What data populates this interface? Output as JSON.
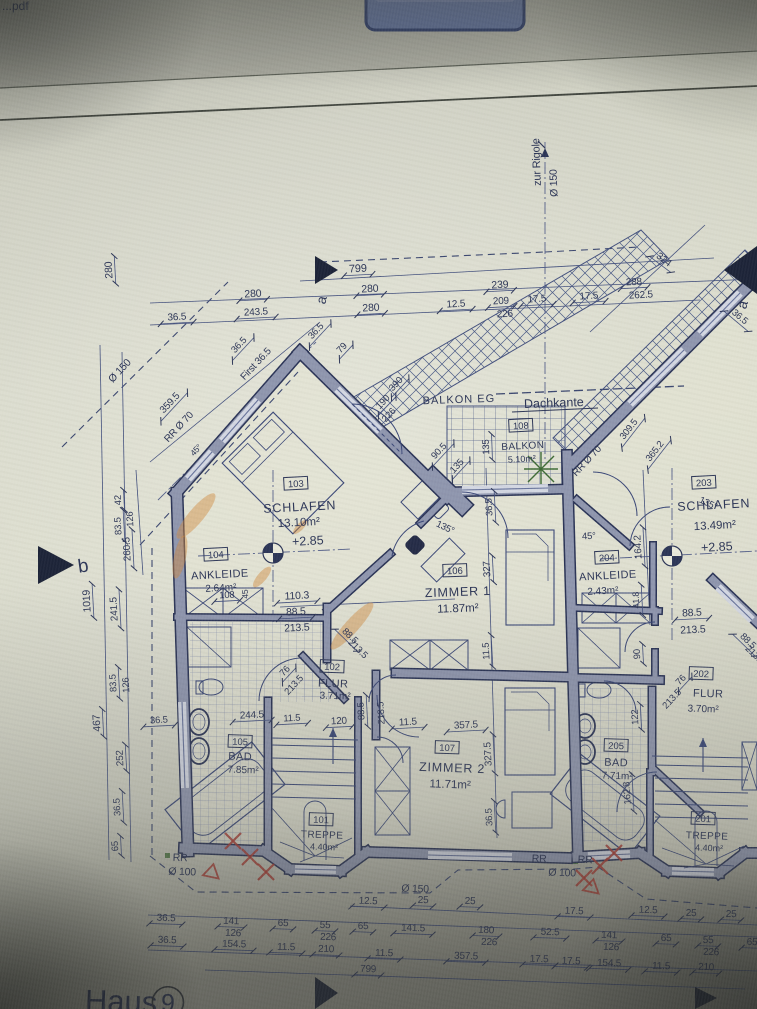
{
  "screen": {
    "filename_fragment": "...pdf"
  },
  "sheet": {
    "house_label": "Haus",
    "house_number": "9",
    "section_marker_a": "a",
    "section_marker_b": "b"
  },
  "plan_labels": {
    "balkon_eg": "BALKON EG",
    "dachkante": "Dachkante"
  },
  "rooms": [
    {
      "number": "103",
      "name": "SCHLAFEN",
      "area": "13.10m²",
      "level": "+2.85"
    },
    {
      "number": "104",
      "name": "ANKLEIDE",
      "area": "2.64m²"
    },
    {
      "number": "105",
      "name": "BAD",
      "area": "7.85m²"
    },
    {
      "number": "102",
      "name": "FLUR",
      "area": "3.71m²"
    },
    {
      "number": "101",
      "name": "TREPPE",
      "area": "4.40m²"
    },
    {
      "number": "106",
      "name": "ZIMMER 1",
      "area": "11.87m²"
    },
    {
      "number": "107",
      "name": "ZIMMER 2",
      "area": "11.71m²"
    },
    {
      "number": "108",
      "name": "BALKON",
      "area": "5.10m²"
    },
    {
      "number": "203",
      "name": "SCHLAFEN",
      "area": "13.49m²",
      "level": "+2.85"
    },
    {
      "number": "204",
      "name": "ANKLEIDE",
      "area": "2.43m²"
    },
    {
      "number": "205",
      "name": "BAD",
      "area": "7.71m²"
    },
    {
      "number": "202",
      "name": "FLUR",
      "area": "3.70m²"
    },
    {
      "number": "201",
      "name": "TREPPE",
      "area": "4.40m²"
    }
  ],
  "dim_texts": [
    "799",
    "280",
    "280",
    "239",
    "36.5",
    "243.5",
    "280",
    "12.5",
    "209",
    "226",
    "17.5",
    "17.5",
    "288",
    "262.5",
    "324",
    "36.5",
    "280",
    "42",
    "83.5",
    "126",
    "260.5",
    "1019",
    "241.5",
    "83.5",
    "126",
    "467",
    "252",
    "36.5",
    "65",
    "Ø 150",
    "359.5",
    "First 36.5",
    "RR Ø 70",
    "45°",
    "36.5",
    "36.5",
    "79",
    "zur Rigole",
    "Ø 150",
    "390",
    "190",
    "226",
    "90.5",
    "135",
    "135",
    "RR Ø 70",
    "309.5",
    "365.2",
    "135°",
    "135°",
    "45°",
    "45",
    "110.3",
    "88.5",
    "213.5",
    "108",
    "88.5",
    "213.5",
    "76",
    "213.5",
    "36.5",
    "327",
    "11.5",
    "88.5",
    "213.5",
    "120",
    "11.5",
    "357.5",
    "327.5",
    "36.5",
    "36.5",
    "244.5",
    "11.5",
    "164.2",
    "41.8",
    "88.5",
    "213.5",
    "88.5",
    "213.5",
    "76",
    "213.5",
    "90",
    "122",
    "162.8",
    "12.5",
    "25",
    "25",
    "17.5",
    "12.5",
    "25",
    "25",
    "36.5",
    "141",
    "126",
    "65",
    "55",
    "226",
    "65",
    "141.5",
    "180",
    "226",
    "52.5",
    "141",
    "126",
    "65",
    "55",
    "226",
    "65",
    "36.5",
    "154.5",
    "11.5",
    "210",
    "11.5",
    "357.5",
    "17.5",
    "17.5",
    "154.5",
    "11.5",
    "210",
    "799",
    "Ø 150",
    "Ø 100",
    "RR",
    "RR",
    "RR",
    "Ø 100"
  ],
  "colors": {
    "wall_fill": "#8f96ae",
    "ink": "#2d3657",
    "highlight_orange": "#d08a3e",
    "markup_red": "#a83c34",
    "plant_green": "#3e6b35",
    "paper": "#d7d8c9",
    "ui_blue": "#5e6e97"
  }
}
